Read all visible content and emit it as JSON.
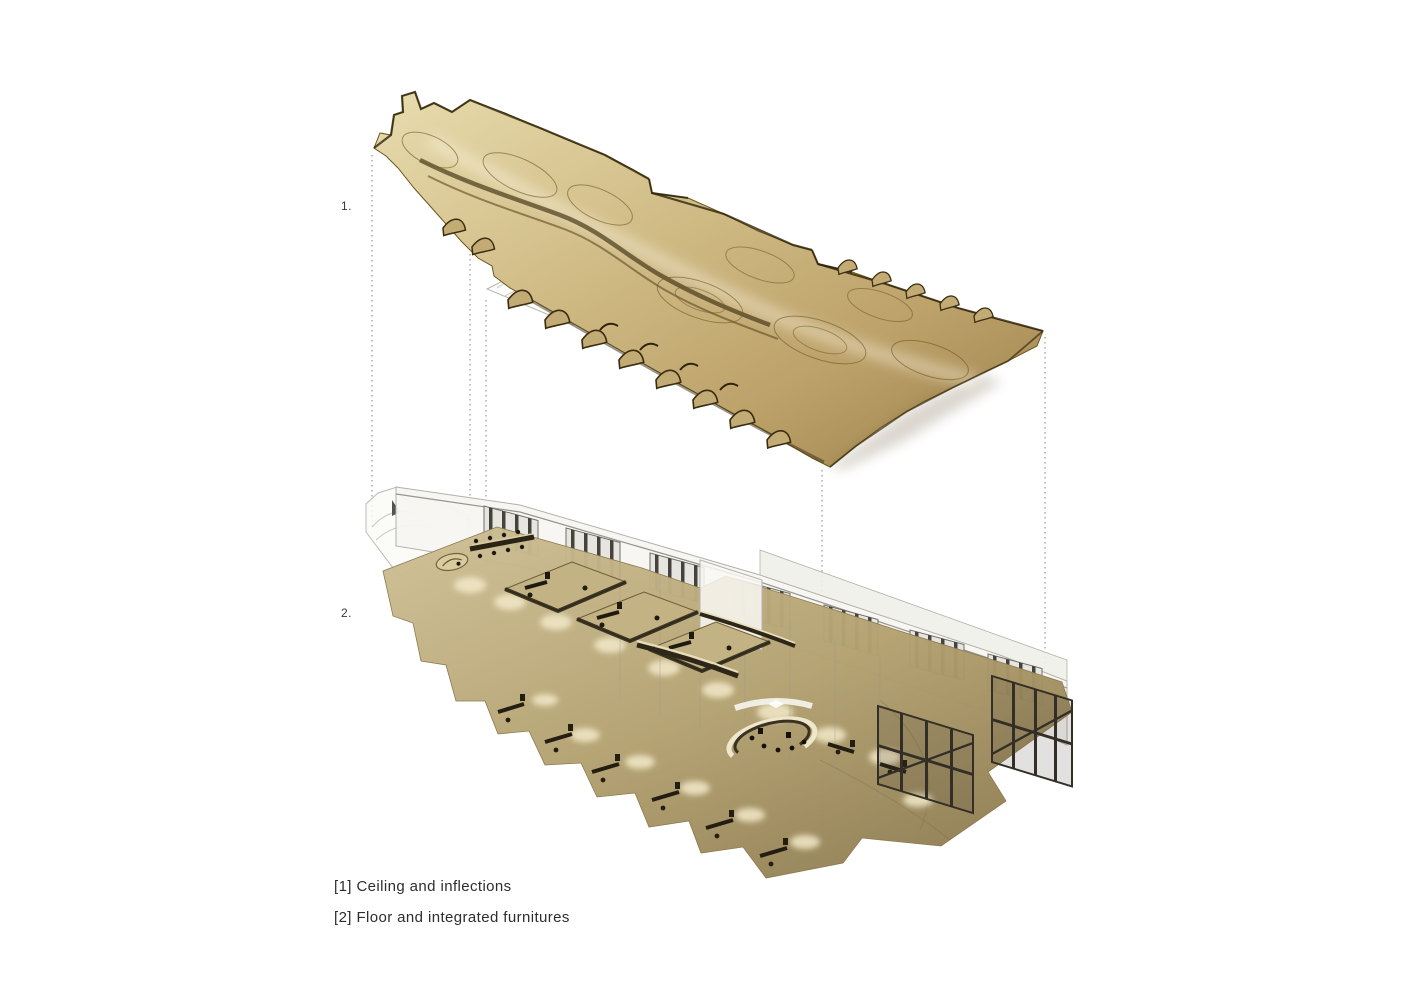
{
  "page": {
    "background": "#ffffff",
    "description": "Exploded axonometric diagram of an interior: undulating gold ceiling above furnished floor plate"
  },
  "diagram": {
    "type": "exploded-axonometric",
    "markers": {
      "marker1": "1.",
      "marker2": "2."
    },
    "layers": [
      {
        "index": "1",
        "name": "ceiling",
        "label": "Ceiling and inflections"
      },
      {
        "index": "2",
        "name": "floor",
        "label": "Floor and integrated furnitures"
      }
    ]
  },
  "legend": {
    "items": [
      {
        "label": "[1] Ceiling and inflections"
      },
      {
        "label": "[2] Floor and integrated furnitures"
      }
    ]
  },
  "colors": {
    "background": "#ffffff",
    "ceiling_gold_light": "#e8dcae",
    "ceiling_gold": "#cdb67f",
    "ceiling_gold_dark": "#9c804a",
    "ceiling_contour": "#5d4a20",
    "ceiling_ridge": "#2e2408",
    "floor_tan_light": "#cfc096",
    "floor_tan": "#b3a170",
    "floor_tan_dark": "#8f7d52",
    "wall_white": "#f3f2ee",
    "window_frame": "#45433b",
    "furniture_dark": "#241f12",
    "ghost_line": "#bcbbb3",
    "connector_gray": "#8c8c88",
    "text_gray": "#2d2d2d"
  }
}
